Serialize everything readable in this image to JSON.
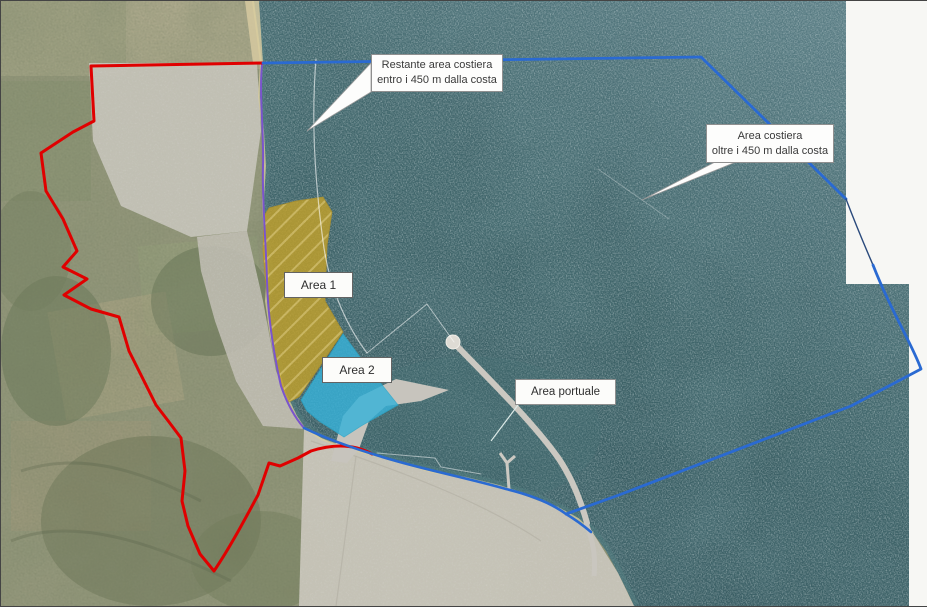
{
  "map": {
    "callouts": {
      "restante": {
        "line1": "Restante area costiera",
        "line2": "entro i 450 m dalla costa"
      },
      "oltre": {
        "line1": "Area costiera",
        "line2": "oltre i 450 m dalla costa"
      },
      "portuale": {
        "label": "Area portuale"
      }
    },
    "areas": {
      "area1": {
        "label": "Area 1"
      },
      "area2": {
        "label": "Area 2"
      }
    },
    "colors": {
      "boundary_red": "#e00000",
      "boundary_blue": "#2a6ad2",
      "boundary_blue_thin": "#2a4a7c",
      "coastline_purple": "#7a55cc",
      "line_450m": "#ffffff",
      "area1_fill": "#c2a12b",
      "area1_hatch": "#e4c55e",
      "area2_fill": "#38b2d9",
      "sea": "#3a5f64",
      "land": "#95987c",
      "urban": "#c7c4ba",
      "background_white": "#f7f7f4",
      "port_gray": "#cbc8c1"
    }
  }
}
